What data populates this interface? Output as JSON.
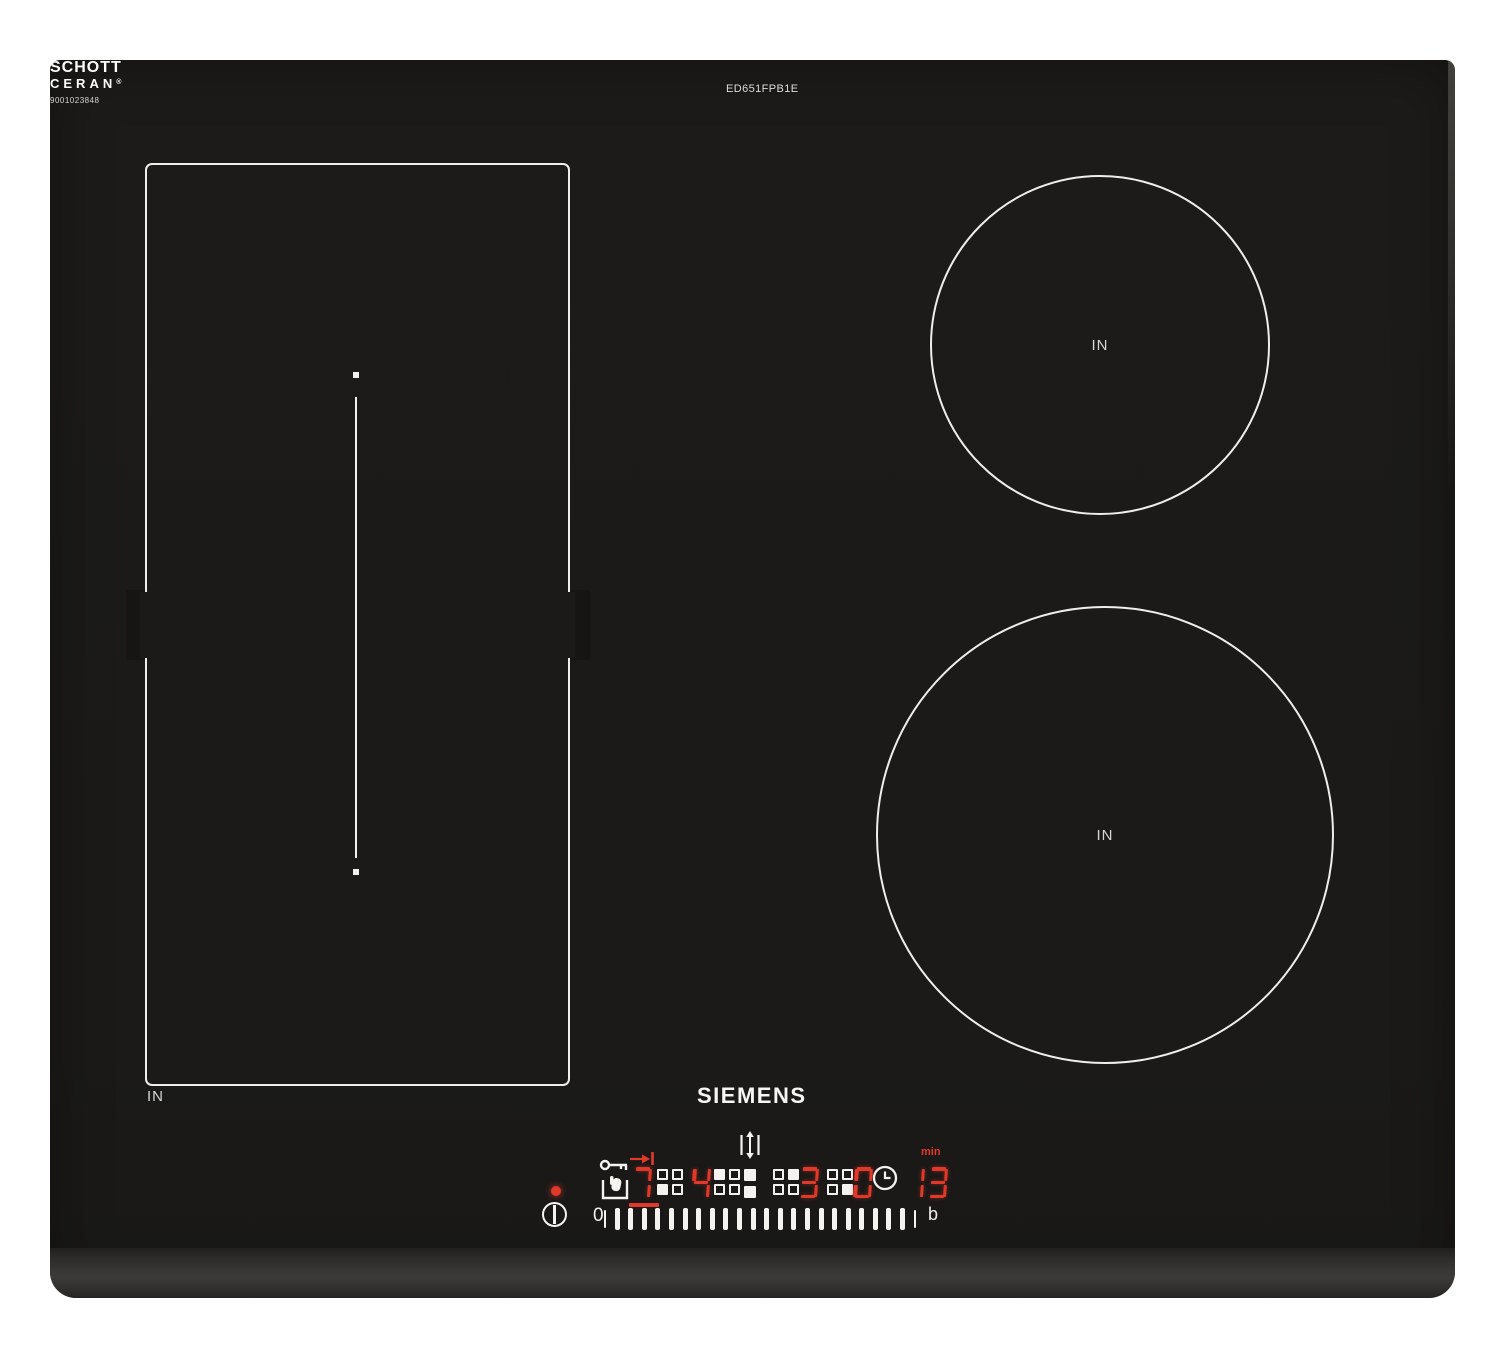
{
  "product": {
    "model_number": "ED651FPB1E",
    "brand_logo": "SIEMENS",
    "glass_brand_line1": "SCHOTT",
    "glass_brand_line2": "CERAN",
    "glass_brand_reg": "®",
    "glass_code": "9001023848"
  },
  "zones": {
    "flex_zone_label": "IN",
    "back_right_zone_label": "IN",
    "front_right_zone_label": "IN"
  },
  "control_panel": {
    "power_led": {
      "state": "on",
      "color": "#e0392a"
    },
    "displays": [
      {
        "zone": "flex-front",
        "power_level": "7",
        "indicator_filled": "bottom-left",
        "selected": true
      },
      {
        "zone": "flex-back",
        "power_level": "4",
        "indicator_filled": "top-left",
        "selected": false
      },
      {
        "zone": "back-right",
        "power_level": "3",
        "indicator_filled": "top-right",
        "selected": false
      },
      {
        "zone": "front-right",
        "power_level": "0",
        "indicator_filled": "bottom-right",
        "selected": false
      }
    ],
    "timer": {
      "value": "13",
      "unit_label": "min"
    },
    "slider": {
      "min_label": "0",
      "max_label": "b",
      "tick_count": 22
    },
    "icons": {
      "power": "power-standby-icon",
      "child_lock": "key-hand-lock-icon",
      "transfer": "move-pan-arrow-icon",
      "flex_connect": "flex-zone-vertical-arrows-icon",
      "zone_pair": "paired-squares-icon",
      "timer_clock": "clock-icon"
    }
  },
  "colors": {
    "glass": "#1b1a18",
    "led_red": "#e0392a",
    "element_white": "#f4f3f0"
  }
}
